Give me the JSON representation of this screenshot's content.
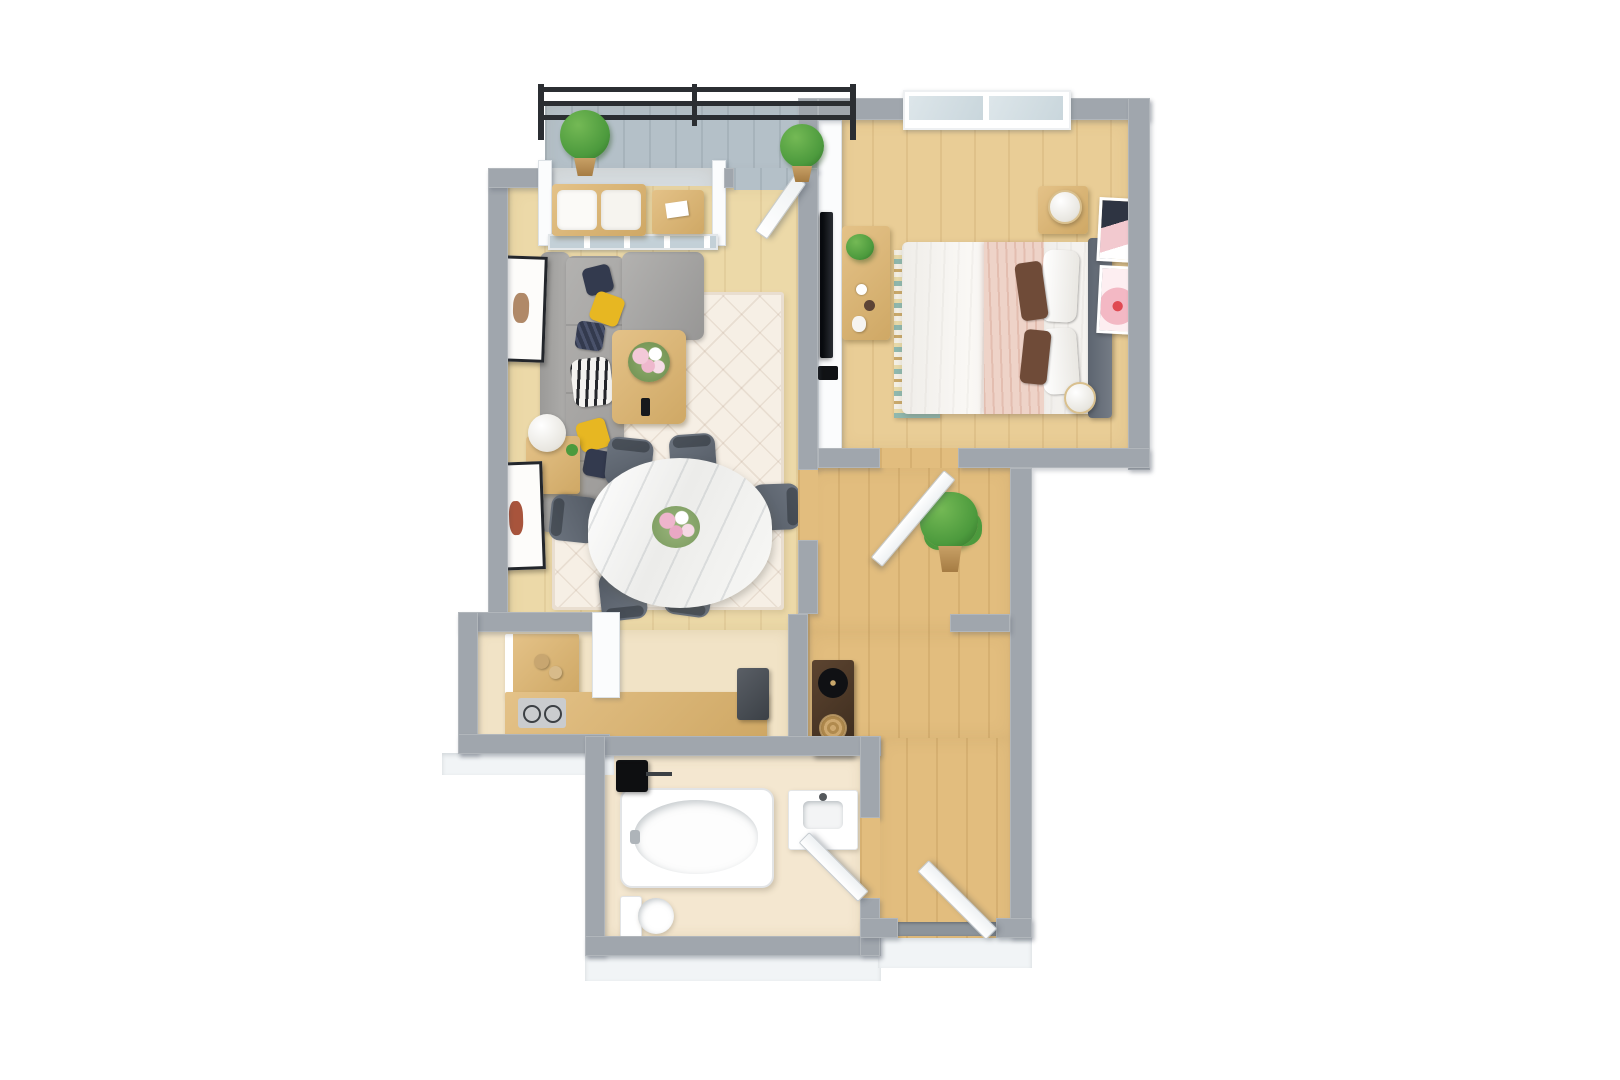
{
  "meta": {
    "title": "3D apartment floor plan render",
    "view": "top-down 3D dollhouse view",
    "canvas": {
      "width": 1620,
      "height": 1080
    }
  },
  "palette": {
    "background": "#ffffff",
    "wall": "#a0a6ad",
    "wall_white_face": "#fbfcfd",
    "wood_living": "#ecd9a8",
    "wood_hall": "#e2bd7e",
    "wood_bedroom": "#e9cd96",
    "tile_kitchen": "#f1e3c6",
    "tile_bath": "#f4e7d0",
    "balcony_floor": "#b4c0c8",
    "railing": "#2b2e32",
    "plant_green": "#4c9a3d",
    "plant_pot": "#b98c4f",
    "sofa_gray": "#a2a1a0",
    "pillow_yellow": "#e7b722",
    "pillow_navy": "#333a4e",
    "rug_cream": "#f6efe5",
    "marble_table": "#f3f3f1",
    "chair_gray": "#5d646e",
    "bed_duvet": "#f4f2ee",
    "bed_pink_throw": "#eed3c8",
    "headboard": "#69707a",
    "pillow_brown": "#6f4b38",
    "tv_black": "#191b1f",
    "console_walnut": "#4e3a29",
    "door_white": "#ffffff",
    "glass": "#c9d6dc",
    "threshold_gray": "#8d949b"
  },
  "rooms": [
    {
      "id": "balcony",
      "furniture": [
        "metal railing",
        "topiary plant left",
        "topiary plant right"
      ]
    },
    {
      "id": "sunroom-bay",
      "furniture": [
        "bench with white cushions",
        "small wood table with magazine",
        "glass sliding doors",
        "open balcony door"
      ]
    },
    {
      "id": "living-room",
      "furniture": [
        "L-shaped gray sectional sofa",
        "yellow pillows x2",
        "navy pillows x3",
        "zebra throw",
        "wall art x2",
        "side table",
        "sphere table lamp",
        "wood coffee table",
        "pink flower bouquet",
        "remote",
        "cream lattice rug",
        "wall-mounted TV",
        "media shelf"
      ]
    },
    {
      "id": "dining-area",
      "furniture": [
        "oval marble dining table",
        "gray dining chairs x6",
        "flower centerpiece"
      ]
    },
    {
      "id": "kitchen",
      "furniture": [
        "L-shaped counter",
        "cooktop with burners",
        "jars",
        "dark appliance cabinet"
      ]
    },
    {
      "id": "bedroom",
      "furniture": [
        "double bed with white duvet",
        "pink throw blanket",
        "white pillows x2",
        "brown pillows x2",
        "dark headboard",
        "nightstand",
        "sphere lamps x2",
        "desk with plants",
        "striped rug",
        "window with two panes",
        "wall art x2"
      ]
    },
    {
      "id": "hallway",
      "furniture": [
        "potted plant",
        "open white door"
      ]
    },
    {
      "id": "foyer",
      "furniture": [
        "walnut record console",
        "vinyl record player",
        "woven basket",
        "open entry door",
        "door threshold"
      ]
    },
    {
      "id": "bathroom",
      "furniture": [
        "bathtub",
        "black shower fixture",
        "vanity sink",
        "toilet",
        "open door"
      ]
    }
  ]
}
